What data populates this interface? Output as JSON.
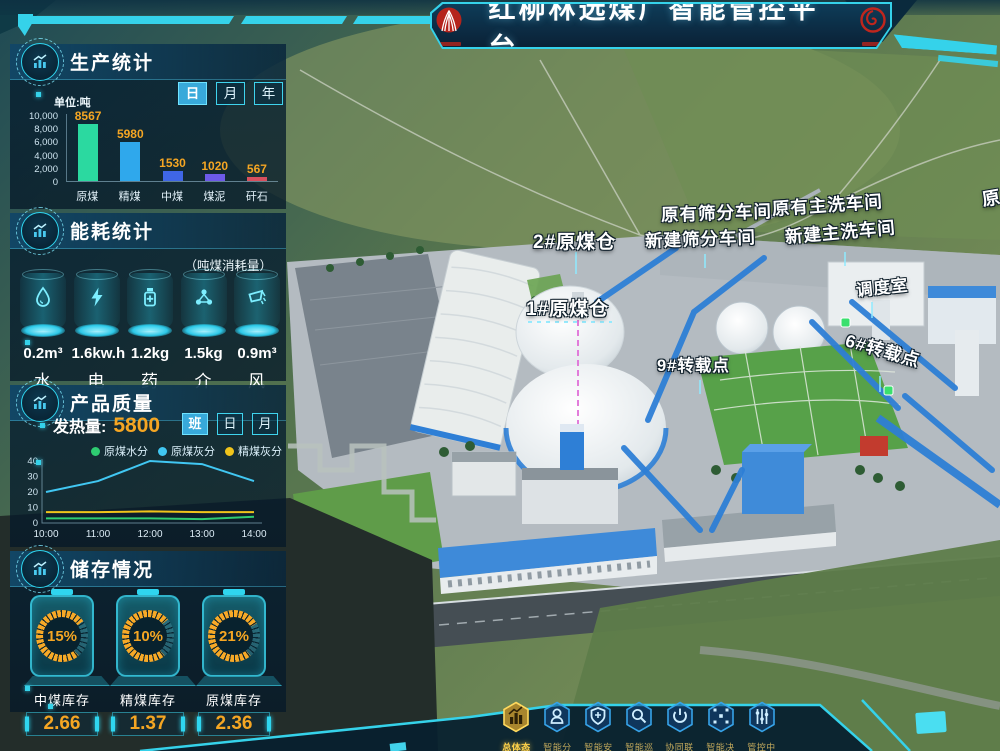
{
  "header": {
    "title": "红柳林选煤厂智能管控平台"
  },
  "production": {
    "title": "生产统计",
    "unit_label": "单位:吨",
    "tabs": [
      {
        "label": "日",
        "active": true
      },
      {
        "label": "月",
        "active": false
      },
      {
        "label": "年",
        "active": false
      }
    ]
  },
  "energy": {
    "title": "能耗统计",
    "subtitle": "（吨煤消耗量）",
    "items": [
      {
        "icon": "water-drop-icon",
        "value": "0.2m³",
        "label": "水"
      },
      {
        "icon": "lightning-icon",
        "value": "1.6kw.h",
        "label": "电"
      },
      {
        "icon": "medicine-bottle-icon",
        "value": "1.2kg",
        "label": "药"
      },
      {
        "icon": "molecule-icon",
        "value": "1.5kg",
        "label": "介"
      },
      {
        "icon": "air-bucket-icon",
        "value": "0.9m³",
        "label": "风"
      }
    ]
  },
  "quality": {
    "title": "产品质量",
    "metric_label": "发热量:",
    "metric_value": "5800",
    "tabs": [
      {
        "label": "班",
        "active": true
      },
      {
        "label": "日",
        "active": false
      },
      {
        "label": "月",
        "active": false
      }
    ]
  },
  "storage": {
    "title": "储存情况",
    "items": [
      {
        "percent": "15%",
        "label": "中煤库存",
        "value": "2.66"
      },
      {
        "percent": "10%",
        "label": "精煤库存",
        "value": "1.37"
      },
      {
        "percent": "21%",
        "label": "原煤库存",
        "value": "2.36"
      }
    ]
  },
  "map": {
    "labels": [
      {
        "text": "2#原煤仓",
        "x": 533,
        "y": 227,
        "size": 19,
        "rotate": 0
      },
      {
        "text": "1#原煤仓",
        "x": 526,
        "y": 294,
        "size": 19,
        "rotate": 0
      },
      {
        "text": "原有筛分车间",
        "x": 661,
        "y": 202,
        "size": 17.5,
        "rotate": -2
      },
      {
        "text": "新建筛分车间",
        "x": 645,
        "y": 228,
        "size": 17.5,
        "rotate": -2
      },
      {
        "text": "原有主洗车间",
        "x": 772,
        "y": 196,
        "size": 17.5,
        "rotate": -4
      },
      {
        "text": "新建主洗车间",
        "x": 785,
        "y": 224,
        "size": 17.5,
        "rotate": -5
      },
      {
        "text": "调度室",
        "x": 856,
        "y": 277,
        "size": 16.5,
        "rotate": -6
      },
      {
        "text": "6#转载点",
        "x": 846,
        "y": 327,
        "size": 17.5,
        "rotate": 16
      },
      {
        "text": "9#转载点",
        "x": 657,
        "y": 352,
        "size": 16.5,
        "rotate": 0
      },
      {
        "text": "原",
        "x": 982,
        "y": 186,
        "size": 18,
        "rotate": -10
      }
    ]
  },
  "nav": {
    "items": [
      {
        "label": "总体态势",
        "icon": "bar-chart-icon",
        "active": true
      },
      {
        "label": "智能分选",
        "icon": "robot-icon",
        "active": false
      },
      {
        "label": "智能安监",
        "icon": "shield-icon",
        "active": false
      },
      {
        "label": "智能巡检",
        "icon": "magnifier-icon",
        "active": false
      },
      {
        "label": "协同联控",
        "icon": "power-icon",
        "active": false
      },
      {
        "label": "智能决策",
        "icon": "network-icon",
        "active": false
      },
      {
        "label": "管控中心",
        "icon": "sliders-icon",
        "active": false
      }
    ]
  },
  "colors": {
    "accent_cyan": "#35d2ea",
    "value_orange": "#f5a623",
    "nav_active_gold": "#ffd24a",
    "conveyor_blue": "#2e7fd6",
    "marker_green": "#3ae06e"
  },
  "chart_data": [
    {
      "type": "bar",
      "title": "生产统计",
      "unit": "吨",
      "categories": [
        "原煤",
        "精煤",
        "中煤",
        "煤泥",
        "矸石"
      ],
      "values": [
        8567,
        5980,
        1530,
        1020,
        567
      ],
      "bar_colors": [
        "#2bd9a0",
        "#2fa8ec",
        "#3f66e6",
        "#6d5ae8",
        "#d8505e"
      ],
      "value_label_color": "#f5a623",
      "ylim": [
        0,
        10000
      ],
      "yticks": [
        0,
        2000,
        4000,
        6000,
        8000,
        10000
      ],
      "ytick_labels": [
        "0",
        "2,000",
        "4,000",
        "6,000",
        "8,000",
        "10,000"
      ]
    },
    {
      "type": "line",
      "title": "产品质量",
      "x": [
        "10:00",
        "11:00",
        "12:00",
        "13:00",
        "14:00"
      ],
      "series": [
        {
          "name": "原煤水分",
          "color": "#2ecc71",
          "values": [
            3,
            3,
            3,
            2.5,
            4
          ]
        },
        {
          "name": "原煤灰分",
          "color": "#41c7f2",
          "values": [
            20,
            27,
            40,
            38,
            27
          ]
        },
        {
          "name": "精煤灰分",
          "color": "#f0c41b",
          "values": [
            7,
            7,
            7.5,
            7,
            7
          ]
        }
      ],
      "ylim": [
        0,
        40
      ],
      "yticks": [
        0,
        10,
        20,
        30,
        40
      ],
      "legend_position": "top"
    }
  ]
}
